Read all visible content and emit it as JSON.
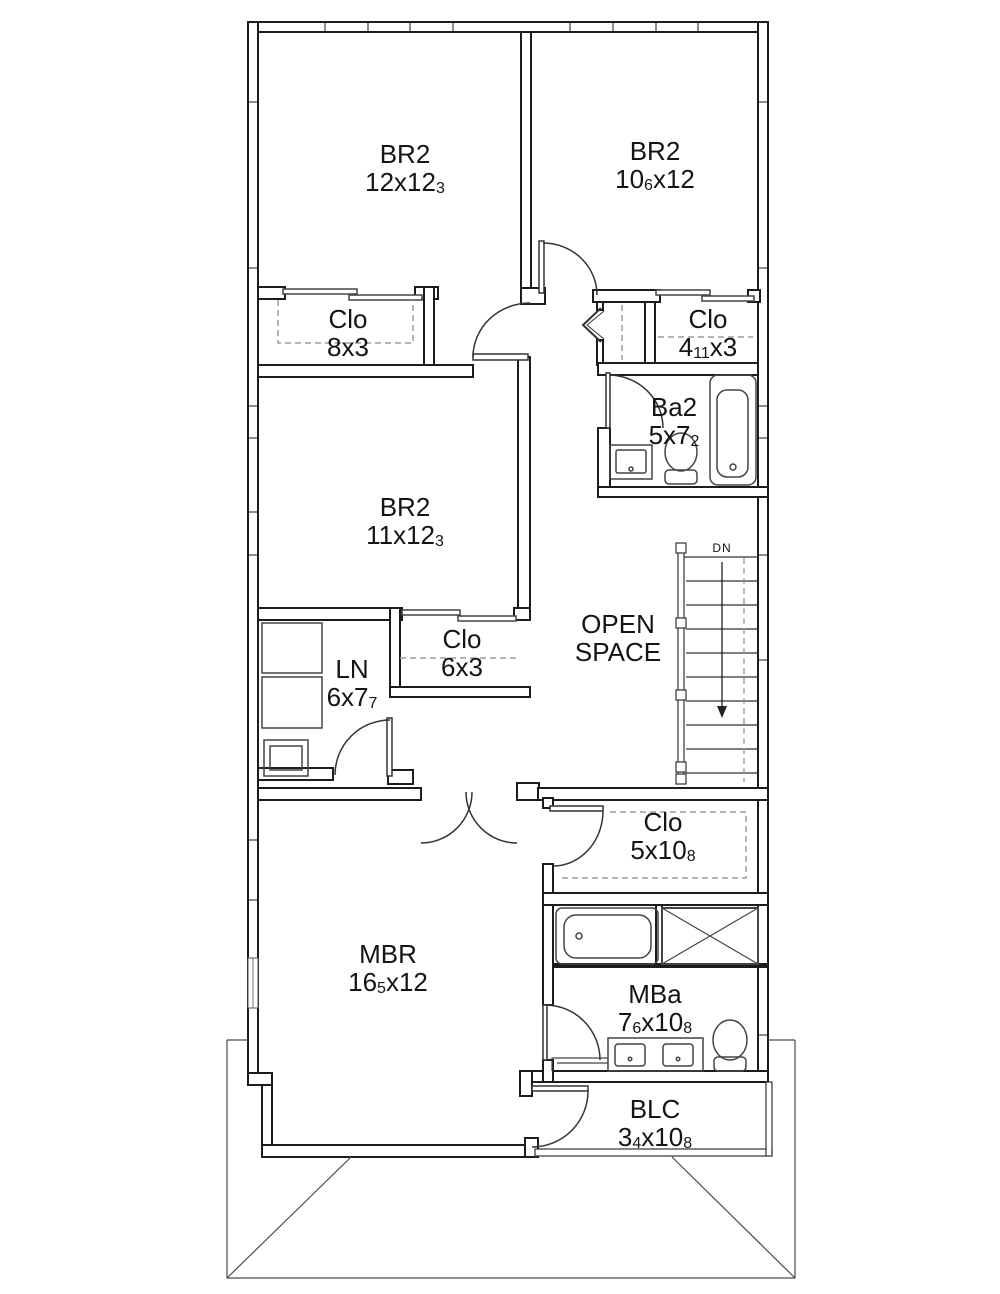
{
  "rooms": [
    {
      "id": "br2-left",
      "name": "BR2",
      "dim": {
        "m1": "12x12",
        "s1": "3"
      }
    },
    {
      "id": "br2-right",
      "name": "BR2",
      "dim": {
        "m1": "10",
        "s1": "6",
        "m2": "x12"
      }
    },
    {
      "id": "clo-left",
      "name": "Clo",
      "dim": {
        "m1": "8x3"
      }
    },
    {
      "id": "clo-right",
      "name": "Clo",
      "dim": {
        "m1": "4",
        "s1": "11",
        "m2": "x3"
      }
    },
    {
      "id": "ba2",
      "name": "Ba2",
      "dim": {
        "m1": "5x7",
        "s1": "2"
      }
    },
    {
      "id": "br2-mid",
      "name": "BR2",
      "dim": {
        "m1": "11x12",
        "s1": "3"
      }
    },
    {
      "id": "open-space",
      "name": "OPEN SPACE",
      "dim": {}
    },
    {
      "id": "clo-hall",
      "name": "Clo",
      "dim": {
        "m1": "6x3"
      }
    },
    {
      "id": "laundry",
      "name": "LN",
      "dim": {
        "m1": "6x7",
        "s1": "7"
      }
    },
    {
      "id": "clo-master",
      "name": "Clo",
      "dim": {
        "m1": "5x10",
        "s1": "8"
      }
    },
    {
      "id": "mbr",
      "name": "MBR",
      "dim": {
        "m1": "16",
        "s1": "5",
        "m2": "x12"
      }
    },
    {
      "id": "mba",
      "name": "MBa",
      "dim": {
        "m1": "7",
        "s1": "6",
        "m2": "x10",
        "s2": "8"
      }
    },
    {
      "id": "blc",
      "name": "BLC",
      "dim": {
        "m1": "3",
        "s1": "4",
        "m2": "x10",
        "s2": "8"
      }
    }
  ],
  "stairs": {
    "down_label": "DN"
  },
  "colors": {
    "wall": "#1c1c1c",
    "thin_line": "#333333",
    "dashed_rod": "#9b9b9b",
    "roof": "#4a4a4a"
  }
}
